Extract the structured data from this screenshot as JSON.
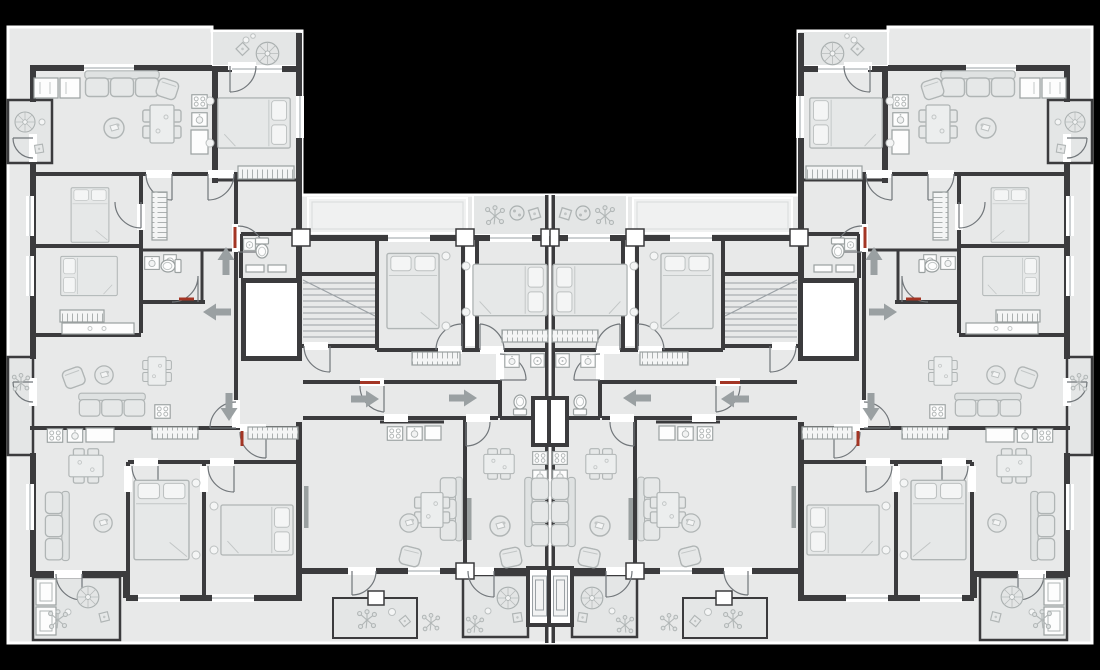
{
  "canvas": {
    "width": 1100,
    "height": 670,
    "background": "#000000"
  },
  "palette": {
    "floor": "#e8e9e9",
    "balcony_floor": "#e4e6e6",
    "terrace_band": "#f0f1f1",
    "wall": "#3b3b3d",
    "outline": "#ffffff",
    "furniture_stroke": "#b0b5b5",
    "fixture_fill": "#fdfdfd",
    "stair_line": "#9aa0a4",
    "arrow": "#9aa0a2",
    "door_arc": "#71767a",
    "red_accent": "#a33524"
  },
  "plan": {
    "type": "residential-apartment-floor-plan",
    "symmetry": "mirrored about vertical centerline",
    "stairwells": 2,
    "elevators": 2,
    "utility_shafts": 4,
    "left_half": {
      "entry_arrows": [
        {
          "x": 226,
          "y": 247,
          "dir": "up"
        },
        {
          "x": 203,
          "y": 312,
          "dir": "left"
        },
        {
          "x": 229,
          "y": 421,
          "dir": "down"
        },
        {
          "x": 379,
          "y": 399,
          "dir": "right"
        },
        {
          "x": 477,
          "y": 398,
          "dir": "right"
        }
      ],
      "red_door_markers": [
        {
          "x": 233.5,
          "y": 227,
          "w": 3,
          "h": 21
        },
        {
          "x": 240.5,
          "y": 431,
          "w": 3,
          "h": 15
        },
        {
          "x": 179,
          "y": 297.5,
          "w": 15,
          "h": 3
        },
        {
          "x": 360,
          "y": 381,
          "w": 20,
          "h": 3
        }
      ]
    },
    "rooms_per_half": [
      "living-room",
      "bedroom",
      "bedroom",
      "bedroom",
      "bedroom",
      "bedroom",
      "kitchen",
      "kitchen",
      "kitchen",
      "bathroom",
      "bathroom",
      "bathroom",
      "corridor",
      "stair-hall"
    ],
    "balconies_per_half": [
      "top-block-balcony",
      "central-top-balcony",
      "terrace-band",
      "upper-left-balcony",
      "mid-left-balcony",
      "bottom-corner-balcony",
      "bottom-center-balcony"
    ],
    "furniture_legend": [
      "double-bed",
      "sofa",
      "armchair",
      "dining-table",
      "round-table",
      "parasol-table",
      "plant",
      "toilet",
      "sink",
      "stove",
      "washer",
      "wardrobe",
      "tv-unit"
    ]
  }
}
